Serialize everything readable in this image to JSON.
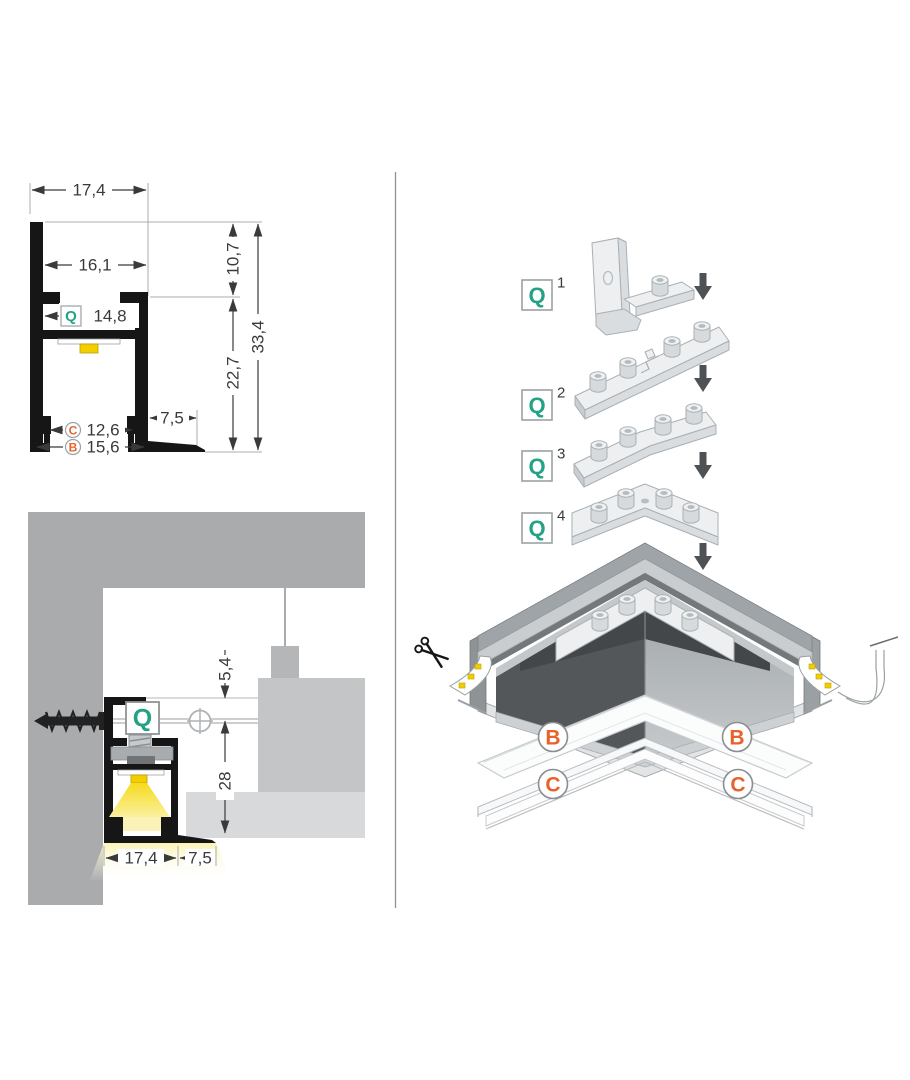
{
  "palette": {
    "teal": "#23A286",
    "orange": "#E8622D",
    "ink": "#3A3A3C",
    "profile_black": "#161616",
    "wall_gray": "#A9ABAD",
    "block_gray": "#C3C5C7",
    "panel_gray": "#D7D9DB",
    "led_yellow": "#F2CE00",
    "beam_yellow": "#F6DB1E",
    "metal_light": "#EDEFF1",
    "metal_dark": "#53575A",
    "arrow_gray": "#4E5255"
  },
  "cross_section": {
    "marker_q": "Q",
    "marker_c": "C",
    "marker_b": "B",
    "dim_top_width": "17,4",
    "dim_inner_width": "16,1",
    "dim_channel_width": "14,8",
    "dim_upper_height": "10,7",
    "dim_total_height": "33,4",
    "dim_lower_height": "22,7",
    "dim_flange_width": "7,5",
    "dim_c_width": "12,6",
    "dim_b_width": "15,6"
  },
  "install": {
    "marker_q": "Q",
    "dim_recess": "5,4",
    "dim_depth": "28",
    "dim_width": "17,4",
    "dim_flange": "7,5"
  },
  "assembly": {
    "steps": [
      {
        "marker": "Q",
        "num": "1"
      },
      {
        "marker": "Q",
        "num": "2"
      },
      {
        "marker": "Q",
        "num": "3"
      },
      {
        "marker": "Q",
        "num": "4"
      }
    ],
    "marker_b": "B",
    "marker_c": "C",
    "scissors_icon": "scissors"
  }
}
